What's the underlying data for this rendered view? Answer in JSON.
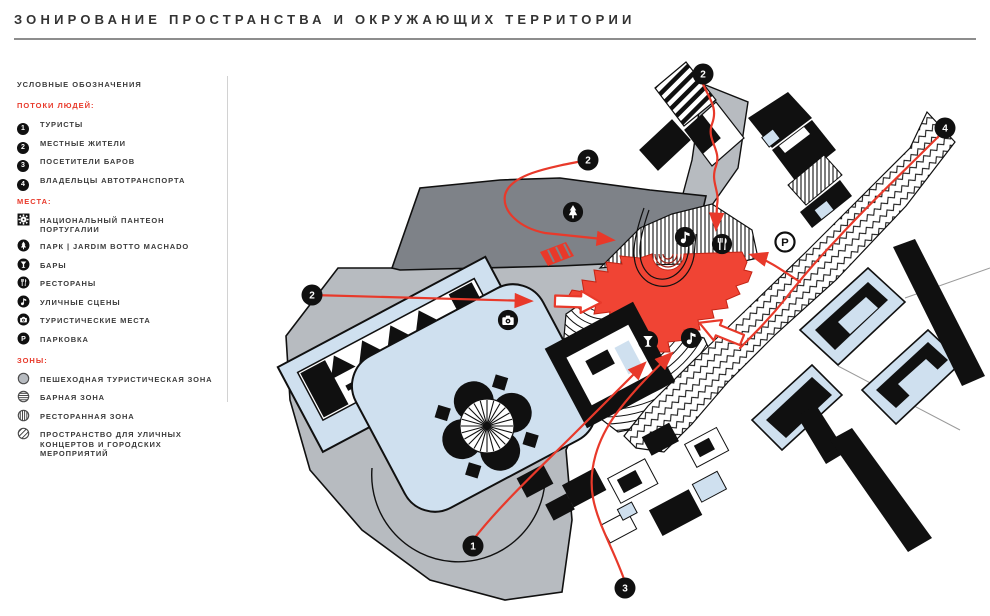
{
  "title": "ЗОНИРОВАНИЕ ПРОСТРАНСТВА И ОКРУЖАЮЩИХ ТЕРРИТОРИИ",
  "colors": {
    "accent_red": "#e8392a",
    "zone_red_fill": "#f04434",
    "pedestrian_gray": "#b7bbc0",
    "park_dark_gray": "#7e8288",
    "building_blue": "#cfe0ef",
    "ink": "#101010"
  },
  "legend": {
    "title": "УСЛОВНЫЕ ОБОЗНАЧЕНИЯ",
    "sections": [
      {
        "heading": "ПОТОКИ ЛЮДЕЙ:",
        "type": "flows",
        "items": [
          {
            "marker": "1",
            "label": "ТУРИСТЫ"
          },
          {
            "marker": "2",
            "label": "МЕСТНЫЕ ЖИТЕЛИ"
          },
          {
            "marker": "3",
            "label": "ПОСЕТИТЕЛИ БАРОВ"
          },
          {
            "marker": "4",
            "label": "ВЛАДЕЛЬЦЫ АВТОТРАНСПОРТА"
          }
        ]
      },
      {
        "heading": "МЕСТА:",
        "type": "places",
        "items": [
          {
            "icon": "pantheon",
            "label": "НАЦИОНАЛЬНЫЙ ПАНТЕОН ПОРТУГАЛИИ"
          },
          {
            "icon": "park",
            "label": "ПАРК | JARDIM BOTTO MACHADO"
          },
          {
            "icon": "bar",
            "label": "БАРЫ"
          },
          {
            "icon": "restaurant",
            "label": "РЕСТОРАНЫ"
          },
          {
            "icon": "music",
            "label": "УЛИЧНЫЕ СЦЕНЫ"
          },
          {
            "icon": "camera",
            "label": "ТУРИСТИЧЕСКИЕ МЕСТА"
          },
          {
            "icon": "parking",
            "label": "ПАРКОВКА"
          }
        ]
      },
      {
        "heading": "ЗОНЫ:",
        "type": "zones",
        "items": [
          {
            "swatch": "solid",
            "label": "ПЕШЕХОДНАЯ ТУРИСТИЧЕСКАЯ ЗОНА"
          },
          {
            "swatch": "hlines",
            "label": "БАРНАЯ ЗОНА"
          },
          {
            "swatch": "vlines",
            "label": "РЕСТОРАННАЯ ЗОНА"
          },
          {
            "swatch": "dlines",
            "label": "ПРОСТРАНСТВО ДЛЯ УЛИЧНЫХ КОНЦЕРТОВ И ГОРОДСКИХ МЕРОПРИЯТИЙ"
          }
        ]
      }
    ]
  },
  "map": {
    "markers": [
      {
        "label": "2",
        "x": 703,
        "y": 74
      },
      {
        "label": "4",
        "x": 945,
        "y": 128
      },
      {
        "label": "2",
        "x": 588,
        "y": 160
      },
      {
        "label": "2",
        "x": 312,
        "y": 295
      },
      {
        "label": "1",
        "x": 473,
        "y": 546
      },
      {
        "label": "3",
        "x": 625,
        "y": 588
      }
    ],
    "icons": [
      {
        "glyph": "park",
        "x": 573,
        "y": 212
      },
      {
        "glyph": "music",
        "x": 685,
        "y": 237
      },
      {
        "glyph": "restaurant",
        "x": 722,
        "y": 244
      },
      {
        "glyph": "parking-outline",
        "x": 785,
        "y": 242
      },
      {
        "glyph": "camera",
        "x": 508,
        "y": 320
      },
      {
        "glyph": "bar",
        "x": 648,
        "y": 341
      },
      {
        "glyph": "music",
        "x": 691,
        "y": 338
      }
    ]
  }
}
